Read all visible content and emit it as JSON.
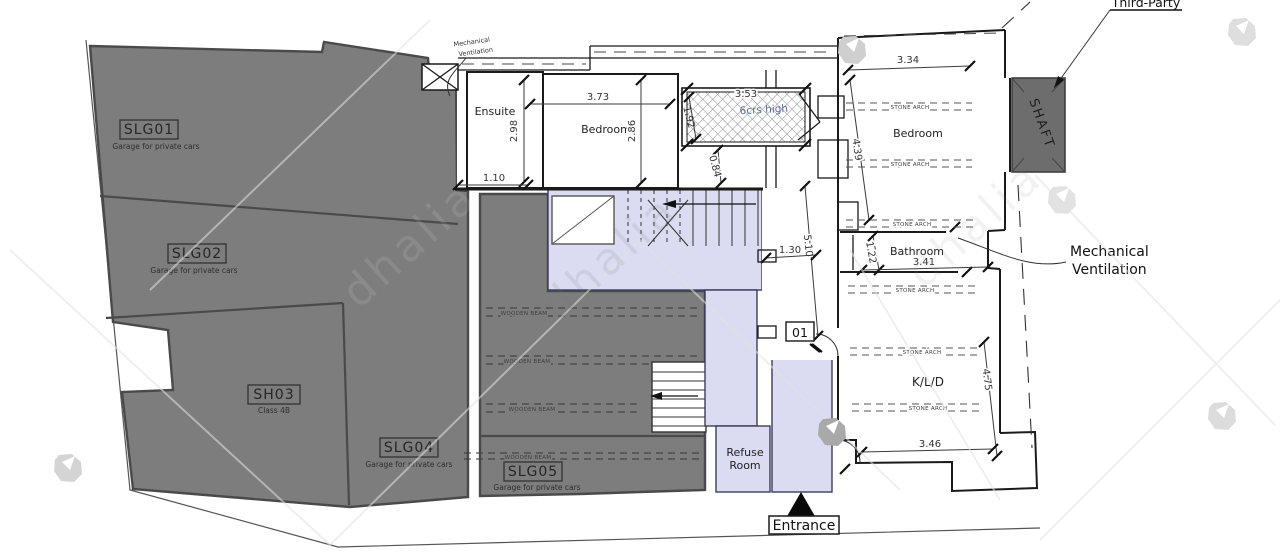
{
  "plan": {
    "garage_units": [
      {
        "id": "SLG01",
        "desc": "Garage for private cars"
      },
      {
        "id": "SLG02",
        "desc": "Garage for private cars"
      },
      {
        "id": "SH03",
        "desc": "Class 4B"
      },
      {
        "id": "SLG04",
        "desc": "Garage for private cars"
      },
      {
        "id": "SLG05",
        "desc": "Garage for private cars"
      }
    ],
    "rooms": {
      "ensuite": "Ensuite",
      "bedroom_left": "Bedroom",
      "bedroom_right": "Bedroom",
      "bathroom": "Bathroom",
      "kld": "K/L/D",
      "refuse_line1": "Refuse",
      "refuse_line2": "Room",
      "shaft": "SHAFT"
    },
    "labels": {
      "stone_arch": "STONE ARCH",
      "wooden_beam": "WOODEN BEAM"
    },
    "annotations": {
      "mech_line1": "Mechanical",
      "mech_line2": "Ventilation",
      "third_party": "Third-Party",
      "entrance": "Entrance",
      "unit_number": "01",
      "chimney_note": "6crs high"
    },
    "dimensions": {
      "d373": "3.73",
      "d298": "2.98",
      "d110": "1.10",
      "d286": "2.86",
      "d353": "3.53",
      "d192": "1.92",
      "d084": "0.84",
      "d334": "3.34",
      "d439": "4.39",
      "d122": "1.22",
      "d341": "3.41",
      "d510": "5.10",
      "d130": "1.30",
      "d475": "4.75",
      "d346": "3.46"
    },
    "watermark": "dhalia",
    "colors": {
      "garage_fill": "#7d7d7d",
      "common_fill": "#dbdbf2",
      "shaft_fill": "#6d6d6d",
      "note_blue": "#5a6d96"
    }
  }
}
